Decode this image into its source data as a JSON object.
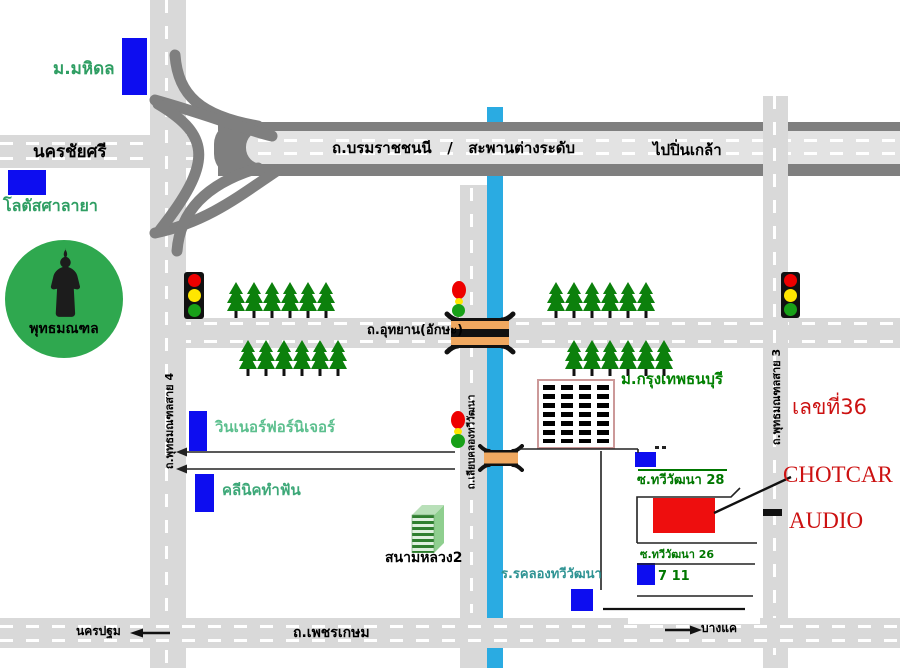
{
  "labels": {
    "mahidol": "ม.มหิดล",
    "nakhon_chai_si": "นครชัยศรี",
    "lotus_salaya": "โลตัสศาลายา",
    "phutthamonthon": "พุทธมณฑล",
    "borom_road": "ถ.บรมราชชนนี   /   สะพานต่างระดับ",
    "to_pinklao": "ไปปิ่นเกล้า",
    "sai4": "ถ.พุทธมณฑลสาย 4",
    "sai3": "ถ.พุทธมณฑลสาย 3",
    "utthayan": "ถ.อุทยาน(อักษะ)",
    "liap_khlong": "ถ.เลียบคลองทวีวัฒนา",
    "bkk_thonburi_univ": "ม.กรุงเทพธนบุรี",
    "winner_furniture": "วินเนอร์ฟอร์นิเจอร์",
    "dental_clinic": "คลีนิคทำฟัน",
    "sanam_luang_2": "สนามหลวง2",
    "school": "ร.รคลองทวีวัฒนา",
    "soi_28": "ซ.ทวีวัฒนา 28",
    "soi_26": "ซ.ทวีวัฒนา 26",
    "seven_eleven": "7 11",
    "house_number": "เลขที่36",
    "shop_name_1": "CHOTCAR",
    "shop_name_2": "AUDIO",
    "phetkasem": "ถ.เพชรเกษม",
    "nakhon_pathom": "นครปฐม",
    "bang_khae": "บางแค"
  },
  "colors": {
    "road_gray": "#d9d9d9",
    "highway_dark_gray": "#7f7f7f",
    "canal_blue": "#2aabe2",
    "marker_blue": "#0d0df0",
    "destination_red": "#ee0e0e",
    "red_text": "#cc1111",
    "green_text_dark": "#007700",
    "green_text_light": "#2f9e63",
    "tree_green": "#0c800c",
    "park_circle_green": "#2fa84f",
    "bridge_orange": "#f0a860"
  }
}
